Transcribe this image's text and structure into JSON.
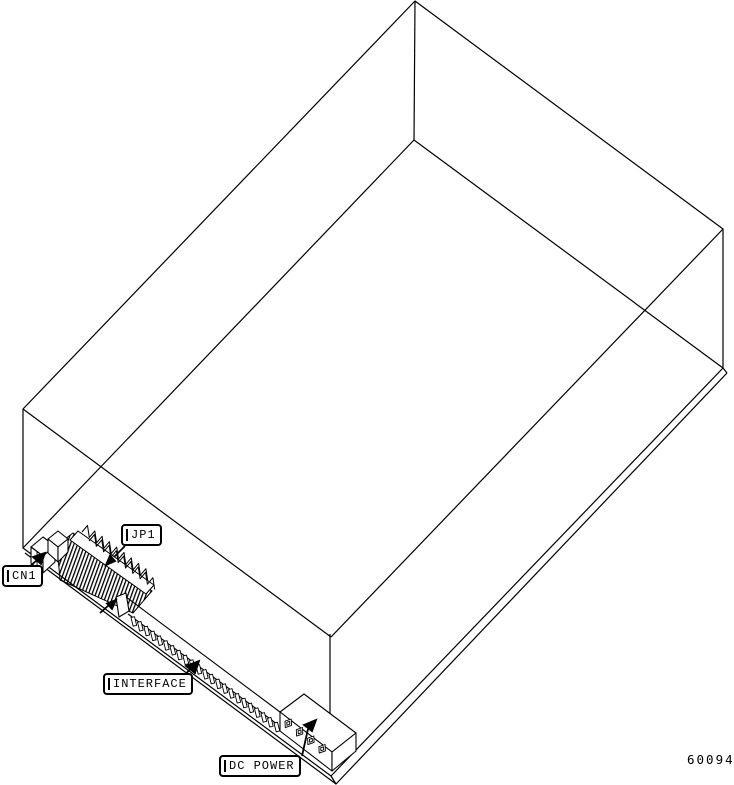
{
  "figure": {
    "type": "isometric technical line drawing",
    "subject": "disk drive underside showing connector and jumper locations",
    "background_color": "#ffffff",
    "line_color": "#000000"
  },
  "callouts": {
    "cn1": {
      "label": "CN1"
    },
    "jp1": {
      "label": "JP1"
    },
    "interface": {
      "label": "INTERFACE"
    },
    "dc_power": {
      "label": "DC POWER"
    }
  },
  "figure_number": "60094"
}
